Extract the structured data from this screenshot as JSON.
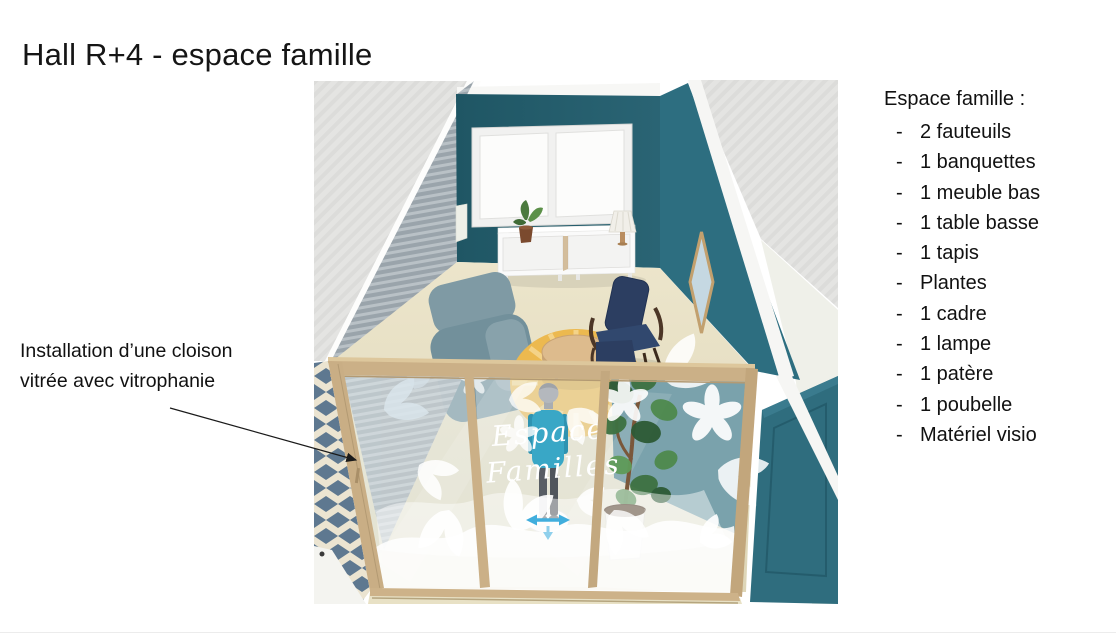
{
  "slide": {
    "title": "Hall R+4 - espace famille",
    "annotation": {
      "text": "Installation d’une cloison vitrée avec vitrophanie"
    },
    "panel_list": {
      "heading": "Espace famille :",
      "bullet": "-",
      "items": [
        "2 fauteuils",
        "1 banquettes",
        "1 meuble bas",
        "1 table basse",
        "1 tapis",
        "Plantes",
        "1 cadre",
        "1 lampe",
        "1 patère",
        "1 poubelle",
        "Matériel visio"
      ]
    },
    "render": {
      "glass_label_line1": "Espace",
      "glass_label_line2": "Familles"
    },
    "colors": {
      "wall_teal": "#255d6c",
      "wall_teal_right": "#2d6e80",
      "door_teal": "#2f6d7e",
      "wood": "#cbb087",
      "floor_beige": "#e8e1c5",
      "rug_gold": "#ecb94f",
      "sofa_slate": "#7f9aa4",
      "chair_navy": "#2c3e61",
      "avatar_shirt": "#39a7c6"
    }
  }
}
